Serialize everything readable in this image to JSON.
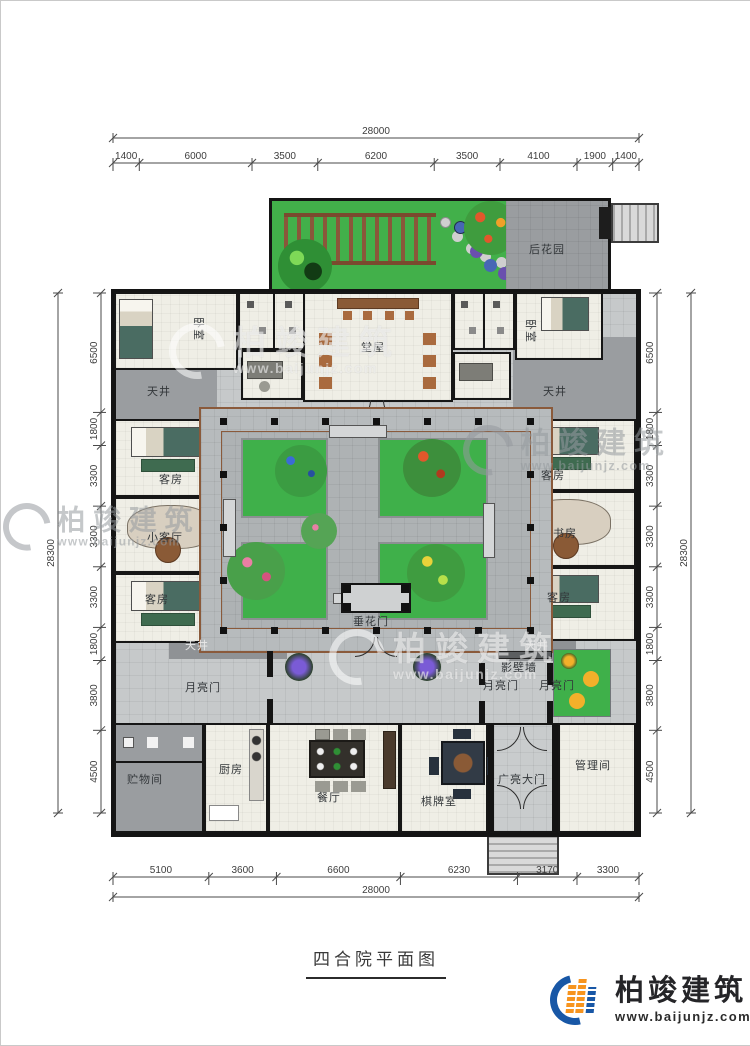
{
  "title": "四合院平面图",
  "logo": {
    "name": "柏竣建筑",
    "url": "www.baijunjz.com"
  },
  "watermark": {
    "name": "柏竣建筑",
    "url": "www.baijunjz.com"
  },
  "rooms": {
    "back_garden": "后花园",
    "bedroom_left": "卧室",
    "bedroom_right": "卧室",
    "hall": "堂屋",
    "courtyard_tl": "天井",
    "courtyard_tr": "天井",
    "courtyard_bl": "天井",
    "courtyard_br": "天井",
    "guest_lt": "客房",
    "small_living": "小客厅",
    "guest_lb": "客房",
    "guest_rt": "客房",
    "study": "书房",
    "guest_rb": "客房",
    "flower_gate": "垂花门",
    "moon_gate_left": "月亮门",
    "moon_gate_mid": "月亮门",
    "moon_gate_right": "月亮门",
    "screen_wall": "影壁墙",
    "storage": "贮物间",
    "kitchen": "厨房",
    "dining": "餐厅",
    "mahjong": "棋牌室",
    "grand_gate": "广亮大门",
    "manager": "管理间"
  },
  "dimensions": {
    "top": {
      "total": "28000",
      "segments": [
        "1400",
        "6000",
        "3500",
        "6200",
        "3500",
        "4100",
        "1900",
        "1400"
      ]
    },
    "bottom": {
      "total": "28000",
      "segments": [
        "5100",
        "3600",
        "6600",
        "6230",
        "3170",
        "3300"
      ]
    },
    "left": {
      "total": "28300",
      "segments": [
        "6500",
        "1800",
        "3300",
        "3300",
        "3300",
        "1800",
        "3800",
        "4500"
      ]
    },
    "right": {
      "total": "28300",
      "segments": [
        "6500",
        "1800",
        "3300",
        "3300",
        "3300",
        "1800",
        "3800",
        "4500"
      ]
    }
  },
  "colors": {
    "lawn_green": "#42b04a",
    "courtyard_walk": "#b7bbbd",
    "corridor_gray": "#c6c9ca",
    "lightwell_gray": "#9a9da0",
    "wall_black": "#141414",
    "wood_brown": "#8a5a3b",
    "logo_blue": "#1857a6",
    "logo_orange": "#f7941e"
  }
}
